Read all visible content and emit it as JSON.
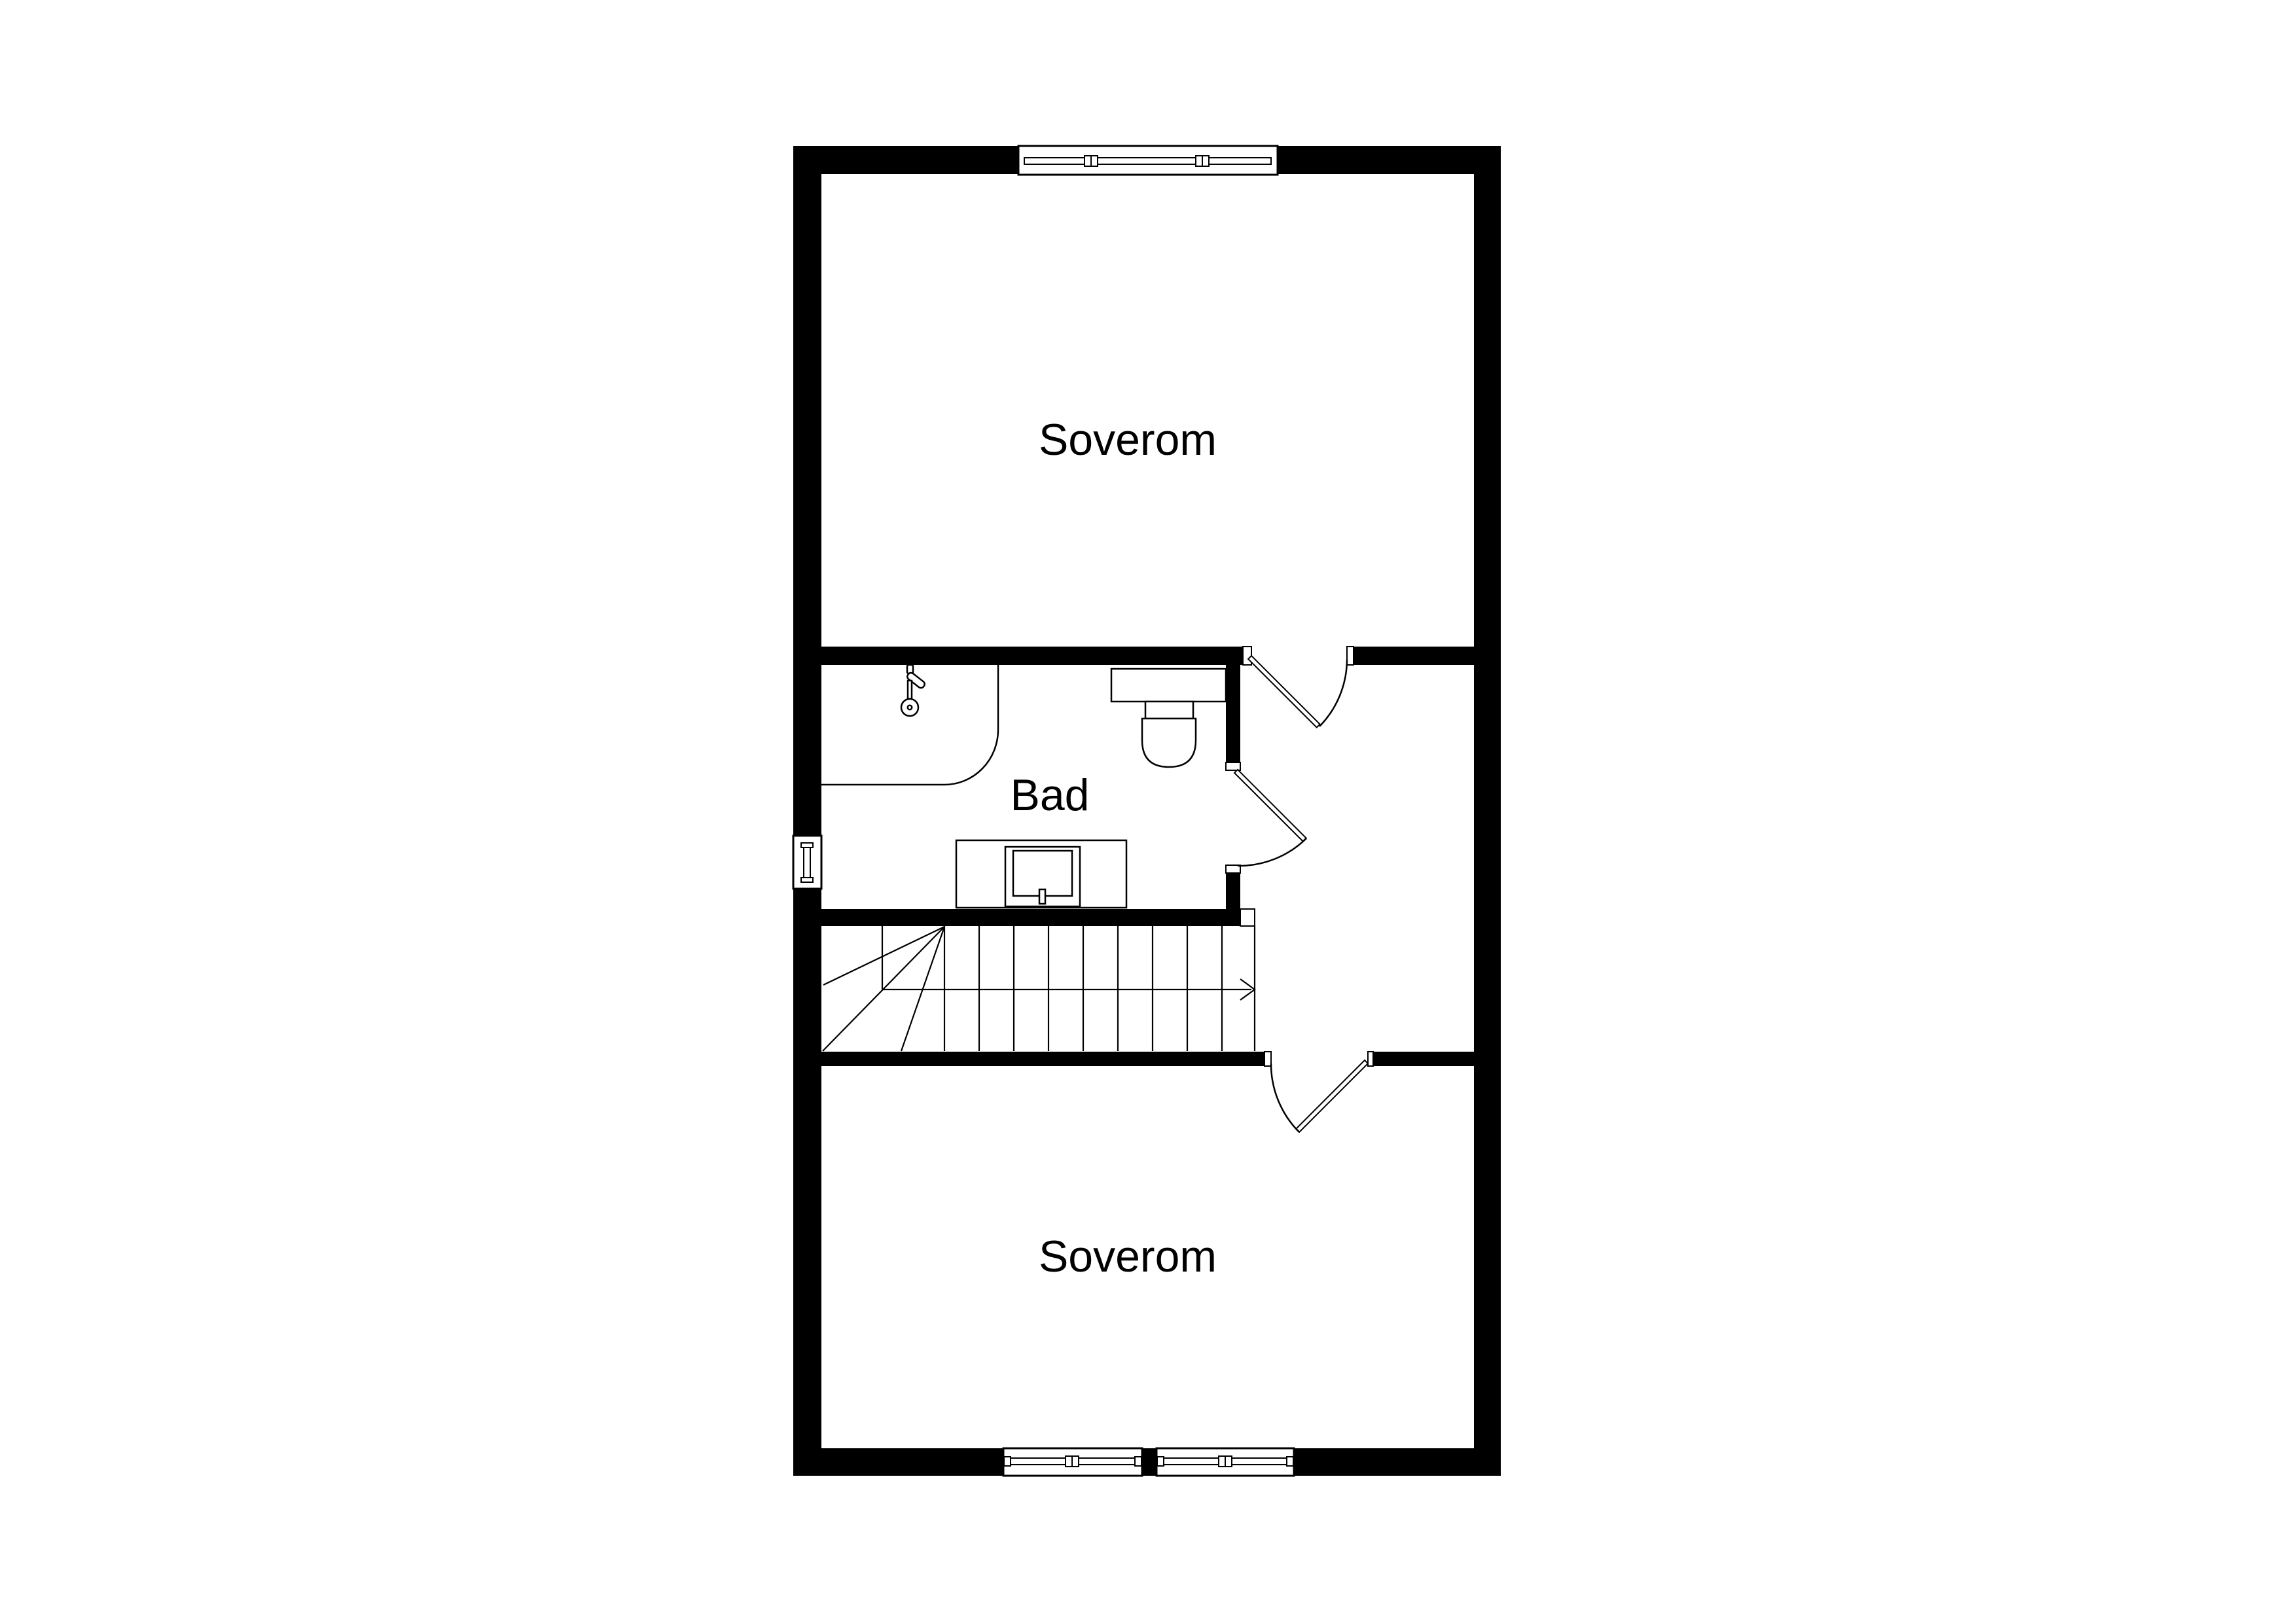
{
  "plan": {
    "type": "floor-plan",
    "rooms": {
      "bedroom_top": {
        "label": "Soverom"
      },
      "bathroom": {
        "label": "Bad"
      },
      "bedroom_bottom": {
        "label": "Soverom"
      }
    },
    "icons": {
      "shower_head": "shower-head-icon",
      "toilet": "toilet-icon",
      "sink_vanity": "sink-vanity-icon",
      "stairs": "staircase-up-arrow"
    },
    "colors": {
      "wall": "#000000",
      "line": "#000000",
      "background": "#ffffff"
    }
  }
}
